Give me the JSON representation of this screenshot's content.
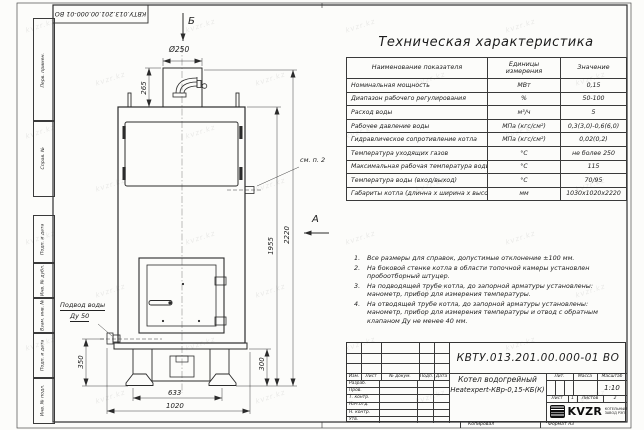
{
  "watermark": "kvzr.kz",
  "frame": {
    "left_labels": [
      "Перв. примен.",
      "Справ. №",
      "Подп. и дата",
      "Инв. № дубл.",
      "Взам. инв. №",
      "Подп. и дата",
      "Инв. № подл."
    ],
    "top_stamp": "КВТУ.013.201.00.000-01 ВО",
    "copy_label": "Копировал",
    "format_label": "Формат А3"
  },
  "drawing": {
    "view_b_label": "Б",
    "view_a_label": "А",
    "note_ref": "см. п. 2",
    "water_supply_line1": "Подвод воды",
    "water_supply_line2": "Ду 50",
    "dims": {
      "d250": "Ø250",
      "h265": "265",
      "h1955": "1955",
      "h2220": "2220",
      "h350": "350",
      "h300": "300",
      "w633": "633",
      "w1020": "1020"
    }
  },
  "table": {
    "title": "Техническая характеристика",
    "headers": [
      "Наименование показателя",
      "Единицы измерения",
      "Значение"
    ],
    "rows": [
      [
        "Номинальная мощность",
        "МВт",
        "0,15"
      ],
      [
        "Диапазон рабочего регулирования",
        "%",
        "50-100"
      ],
      [
        "Расход воды",
        "м³/ч",
        "5"
      ],
      [
        "Рабочее давление воды",
        "МПа (кгс/см²)",
        "0,3(3,0)-0,6(6,0)"
      ],
      [
        "Гидравлическое сопротивление котла",
        "МПа (кгс/см²)",
        "0,02(0,2)"
      ],
      [
        "Температура уходящих газов",
        "°С",
        "не более 250"
      ],
      [
        "Максимальная рабочая температура воды",
        "°С",
        "115"
      ],
      [
        "Температура воды (вход/выход)",
        "°С",
        "70/95"
      ],
      [
        "Габариты котла (длинна х ширина х высота)",
        "мм",
        "1030х1020х2220"
      ]
    ]
  },
  "notes": {
    "items": [
      "Все размеры для справок, допустимые отклонение ±100 мм.",
      "На боковой стенке котла в области топочной камеры установлен пробоотборный штуцер.",
      "На подводящей трубе котла, до запорной арматуры установлены: манометр, прибор для измерения температуры.",
      "На отводящей трубе котла, до запорной арматуры установлены: манометр, прибор для измерения температуры и отвод с обратным клапаном Ду не менее 40 мм."
    ]
  },
  "title_block": {
    "doc_number": "КВТУ.013.201.00.000-01 ВО",
    "grid_headers": [
      "Изм.",
      "Лист",
      "№ докум.",
      "Подп.",
      "Дата"
    ],
    "row_labels": [
      "Разраб.",
      "Пров.",
      "Т. контр.",
      "Нач.отд.",
      "Н. контр.",
      "Утв."
    ],
    "product_line1": "Котел водогрейный",
    "product_line2": "Heatexpert-КВр-0,15-КБ(К)",
    "lit_label": "Лит.",
    "mass_label": "Масса",
    "scale_label": "Масштаб",
    "scale_value": "1:10",
    "sheet_label": "Лист",
    "sheet_value": "1",
    "sheets_label": "Листов",
    "sheets_value": "2",
    "company_name": "KVZR",
    "company_desc1": "КОТЕЛЬНЫЙ",
    "company_desc2": "ЗАВОД РЭП"
  }
}
